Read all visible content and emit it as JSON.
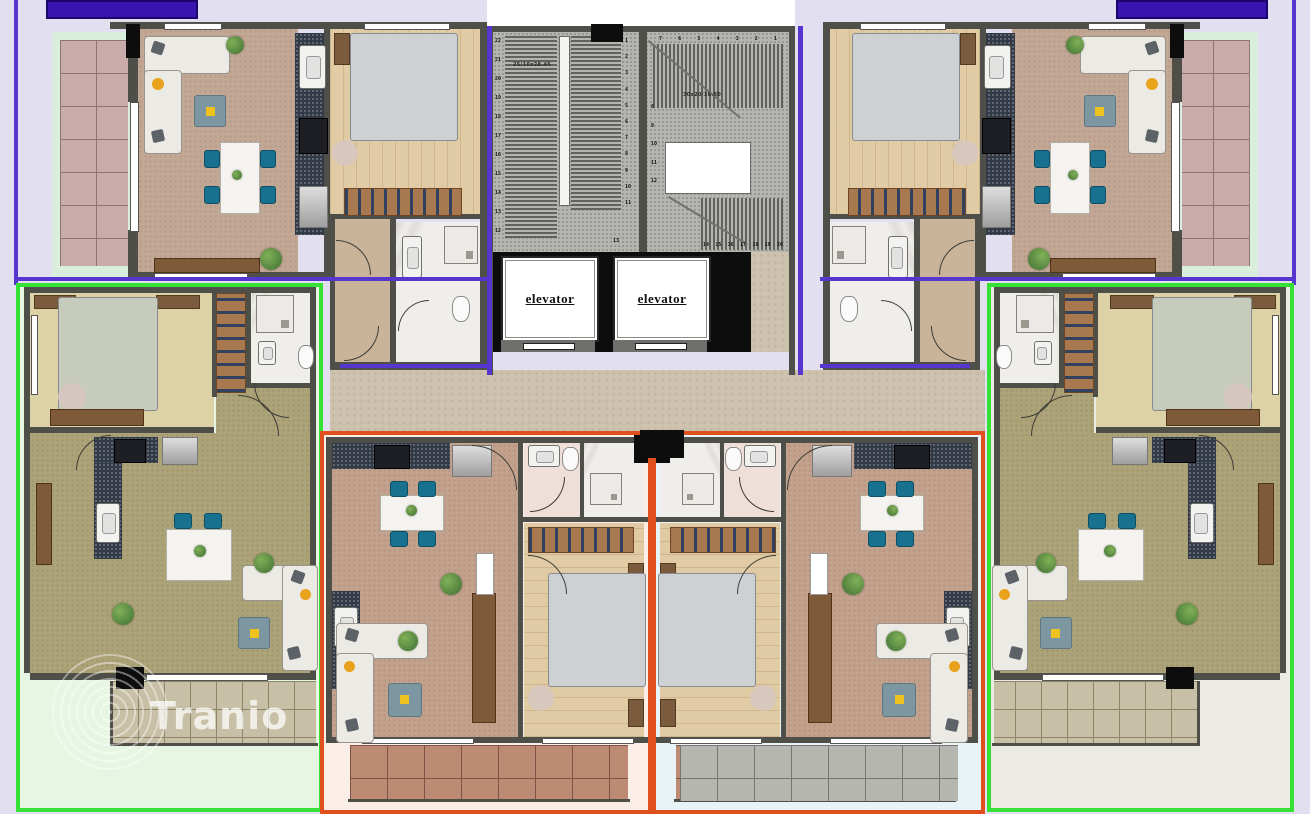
{
  "watermark": {
    "brand": "Tranio"
  },
  "stairwell": {
    "elevators": {
      "left_label": "elevator",
      "right_label": "elevator"
    },
    "left_flight": {
      "label": "25/10x28.45",
      "outer_steps": [
        "22",
        "21",
        "20",
        "19",
        "18",
        "17",
        "16",
        "15",
        "14",
        "13",
        "12"
      ],
      "inner_steps": [
        "1",
        "2",
        "3",
        "4",
        "5",
        "6",
        "7",
        "8",
        "9",
        "10",
        "11"
      ]
    },
    "right_flight": {
      "label": "30x20/16.80",
      "top_steps": [
        "7",
        "6",
        "5",
        "4",
        "3",
        "2",
        "1"
      ],
      "mid_steps": [
        "8",
        "9",
        "10",
        "11",
        "12"
      ],
      "corner_step": "13",
      "bottom_steps": [
        "14",
        "15",
        "16",
        "17",
        "18",
        "19",
        "20"
      ]
    }
  },
  "zones": {
    "apartment_outline_top": "#5636cf",
    "apartment_outline_bottom_sides": "#35e135",
    "apartment_outline_bottom_center": "#e0501e"
  },
  "colors": {
    "background_top": "#e2dff1",
    "background_bottom_left": "#e7f6e3",
    "background_bottom_center_left": "#fbeee7",
    "background_bottom_center_right": "#e7f3f7",
    "background_bottom_right": "#ebeae3",
    "banner_fill": "#3a14ae",
    "balcony_tiles_pink": "#c9abab",
    "balcony_tiles_beige": "#c8c0a6",
    "balcony_tiles_red": "#bd8a74",
    "balcony_tiles_gray": "#b6b6b0"
  }
}
